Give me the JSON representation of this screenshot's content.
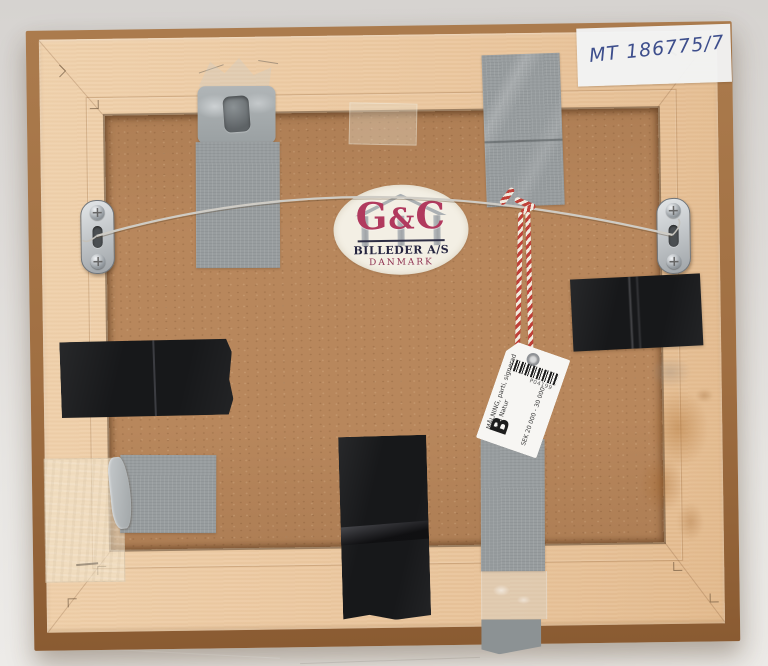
{
  "scene": {
    "description": "Back of a light wooden picture frame on a grey backdrop: hardboard backing, steel hanging wire between two metal plate hangers, grey duct tape and black tape patches, oval maker label, red-and-white string with auction tag, handwritten inventory number on white tape",
    "colors": {
      "backdrop": "#e4e2df",
      "frame_wood": "#ebc9a2",
      "frame_edge": "#9d6c41",
      "backing": "#b8875c",
      "duct_tape": "#989d9f",
      "black_tape": "#17181a",
      "string_red": "#c04038",
      "label_accent": "#b13a5e"
    }
  },
  "inventory_label": {
    "text": "MT 186775/7"
  },
  "maker_label": {
    "initial_left": "G",
    "ampersand": "&",
    "initial_right": "C",
    "company": "BILLEDER A/S",
    "country": "DANMARK"
  },
  "auction_tag": {
    "barcode_number": "P04199",
    "description_line1": "MÅLNING, parti, signerad",
    "description_line2": "med Natur",
    "estimate": "SEK 20 000 - 30 000",
    "section_letter": "B"
  }
}
